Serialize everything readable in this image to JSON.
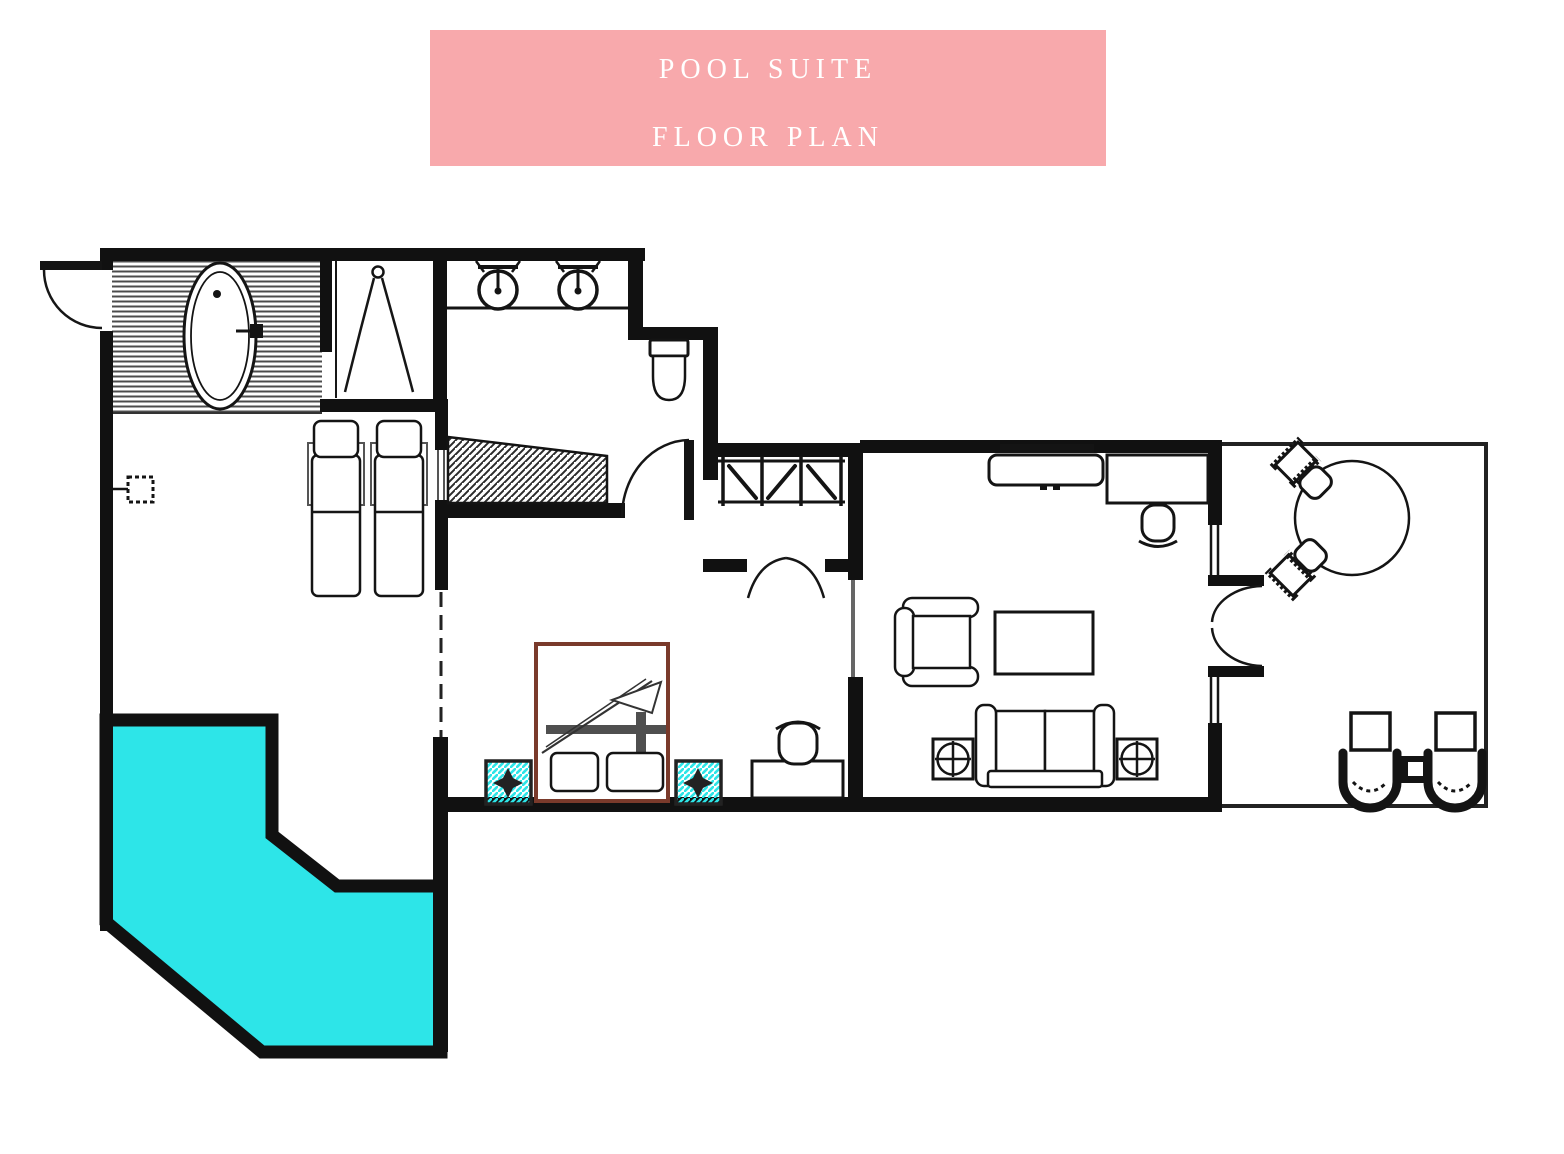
{
  "header": {
    "line1": "POOL SUITE",
    "line2": "FLOOR PLAN"
  },
  "colors": {
    "banner": "#f8a9ac",
    "banner_text": "#ffffff",
    "wall": "#111111",
    "pool_water": "#2de5e8",
    "accent_cyan": "#2de5e8",
    "bed_frame": "#7a3a2b",
    "deck_stripe": "#4c4c4c",
    "background": "#ffffff"
  }
}
